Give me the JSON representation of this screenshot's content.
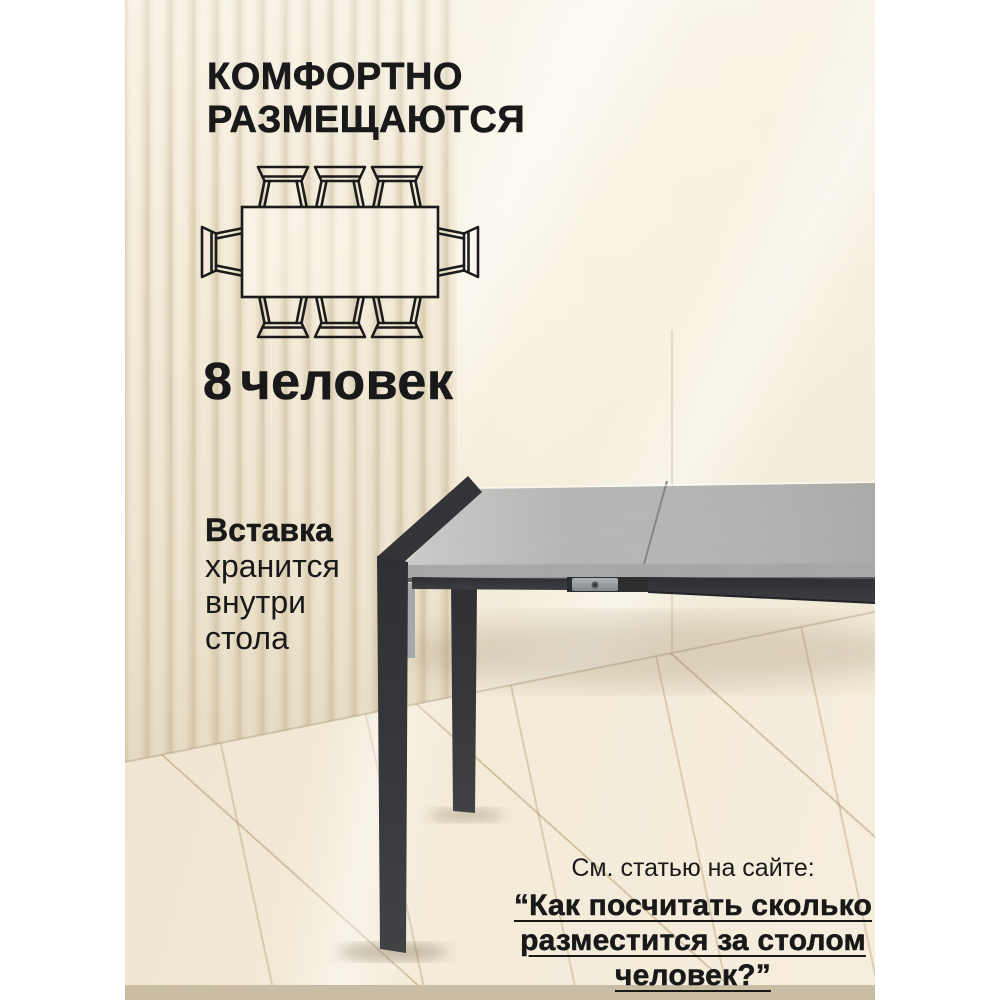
{
  "headline": {
    "line1": "КОМФОРТНО",
    "line2": "РАЗМЕЩАЮТСЯ"
  },
  "capacity": {
    "number": "8",
    "label": "человек"
  },
  "insert_note": {
    "line1": "Вставка",
    "line2": "хранится",
    "line3": "внутри",
    "line4": "стола"
  },
  "footer": {
    "intro": "См. статью на сайте:",
    "title_line1": "“Как посчитать сколько",
    "title_line2": "разместится за столом",
    "title_line3": "человек?”"
  },
  "diagram": {
    "name": "table-seating-top-view",
    "seats_total": 8,
    "seats_top": 3,
    "seats_bottom": 3,
    "seats_left": 1,
    "seats_right": 1
  },
  "colors": {
    "text": "#191919",
    "tabletop": "#b5b6b4",
    "tabletop_edge": "#a5a6a4",
    "table_frame": "#38393c",
    "wall": "#f7f1e1",
    "slat_gap": "#d8cbaf",
    "floor": "#f1e8d4",
    "side_padding": "#ffffff"
  }
}
